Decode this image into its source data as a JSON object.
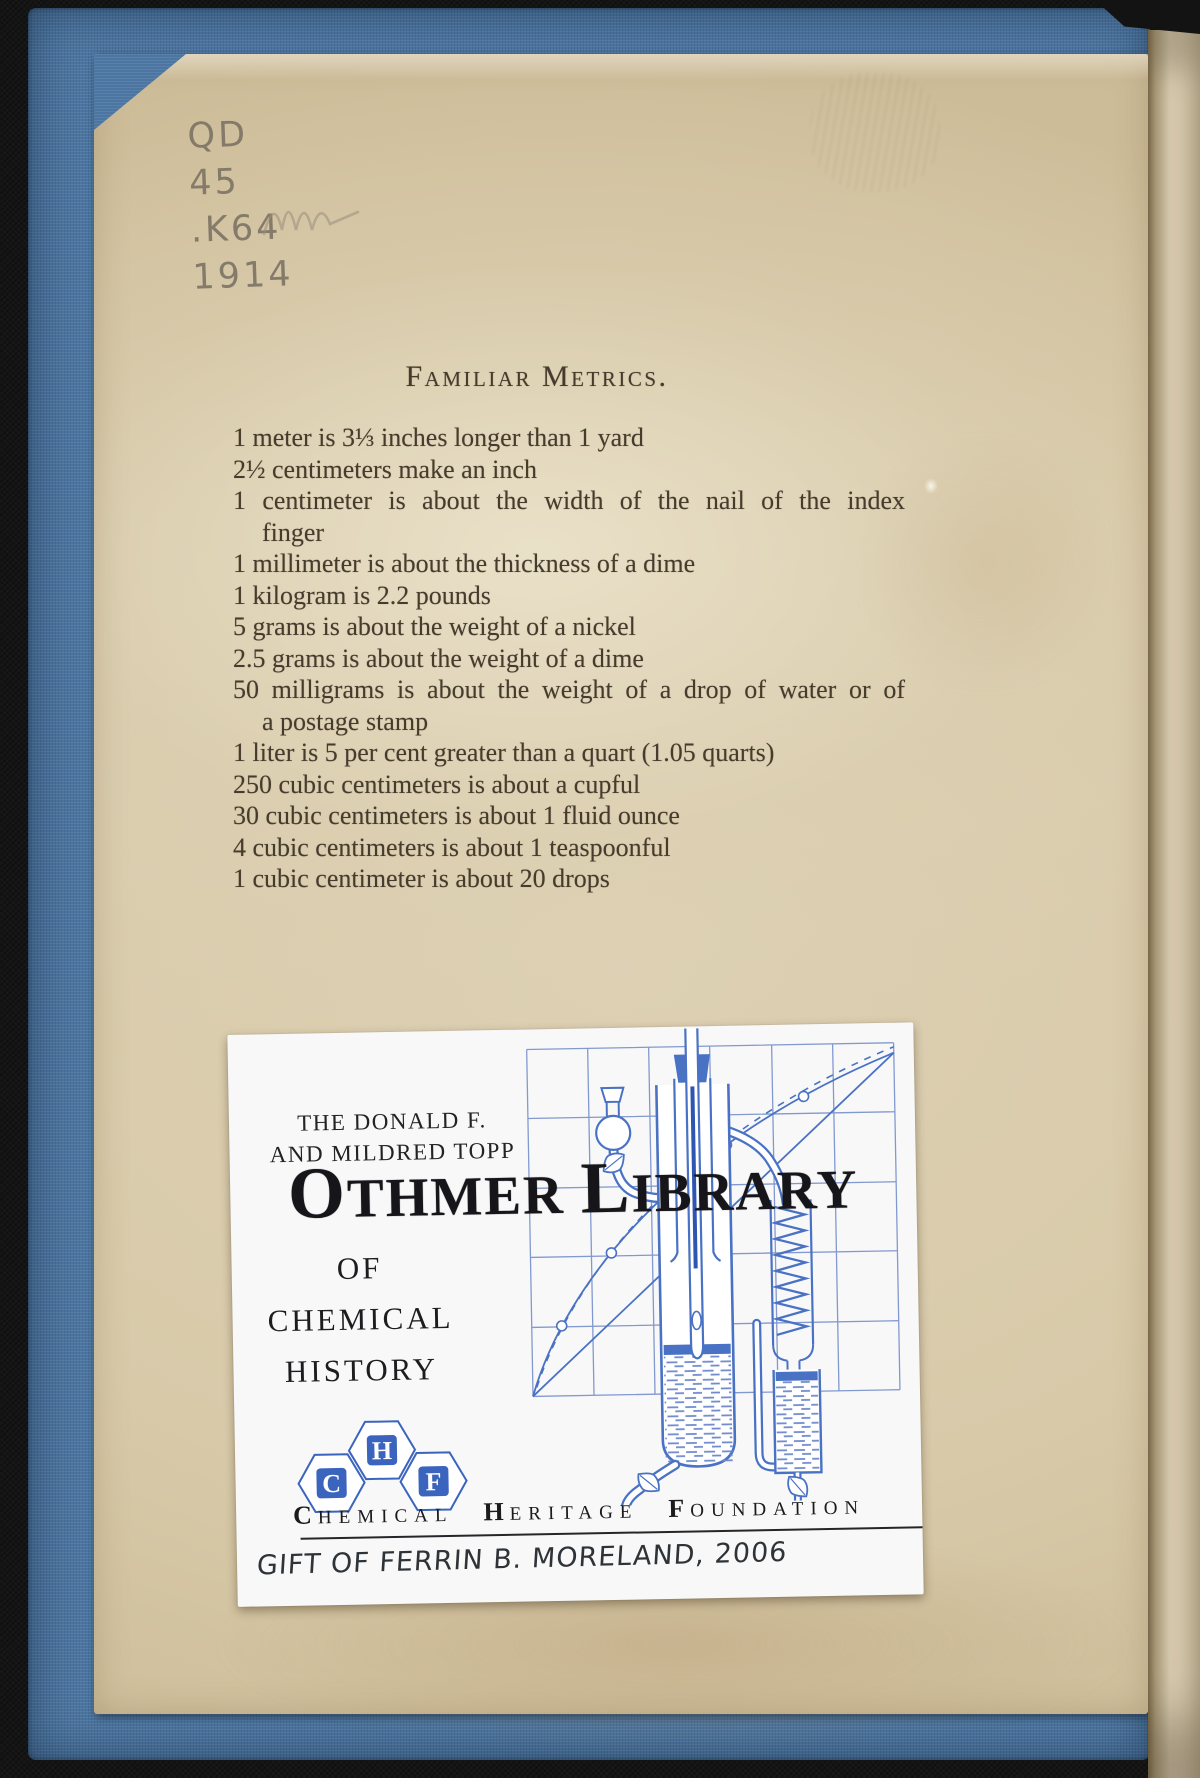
{
  "scan": {
    "call_number": {
      "l0": "QD",
      "l1": "45",
      "l2": ".K64",
      "l3": "1914"
    },
    "metrics": {
      "title": "Familiar Metrics.",
      "lines": [
        {
          "t": "1 meter is 3⅓ inches longer than 1 yard"
        },
        {
          "t": "2½ centimeters make an inch"
        },
        {
          "t": "1 centimeter is about the width of the nail of the index"
        },
        {
          "t": "finger"
        },
        {
          "t": "1 millimeter is about the thickness of a dime"
        },
        {
          "t": "1 kilogram is 2.2 pounds"
        },
        {
          "t": "5 grams is about the weight of a nickel"
        },
        {
          "t": "2.5 grams is about the weight of a dime"
        },
        {
          "t": "50 milligrams is about the weight of a drop of water or of"
        },
        {
          "t": "a postage stamp"
        },
        {
          "t": "1 liter is 5 per cent greater than a quart (1.05 quarts)"
        },
        {
          "t": "250 cubic centimeters is about a cupful"
        },
        {
          "t": "30 cubic centimeters is about 1 fluid ounce"
        },
        {
          "t": "4 cubic centimeters is about 1 teaspoonful"
        },
        {
          "t": "1 cubic centimeter is about 20 drops"
        }
      ]
    },
    "bookplate": {
      "presenter_line1": "THE DONALD F.",
      "presenter_line2": "AND MILDRED TOPP",
      "title": {
        "w1_lead": "O",
        "w1_rest": "THMER",
        "w2_lead": "L",
        "w2_rest": "IBRARY"
      },
      "subtitle": [
        "OF",
        "CHEMICAL",
        "HISTORY"
      ],
      "logo_letters": [
        "C",
        "H",
        "F"
      ],
      "org": [
        {
          "lead": "C",
          "rest": "HEMICAL"
        },
        {
          "lead": "H",
          "rest": "ERITAGE"
        },
        {
          "lead": "F",
          "rest": "OUNDATION"
        }
      ],
      "inscription": "Gift of Ferrin B. Moreland, 2006"
    },
    "colors": {
      "cover_blue": "#4c76a1",
      "plate_blue": "#4a72c4",
      "logo_blue": "#3a64bd",
      "ink": "#463c2d",
      "pencil": "#7e7566"
    }
  }
}
